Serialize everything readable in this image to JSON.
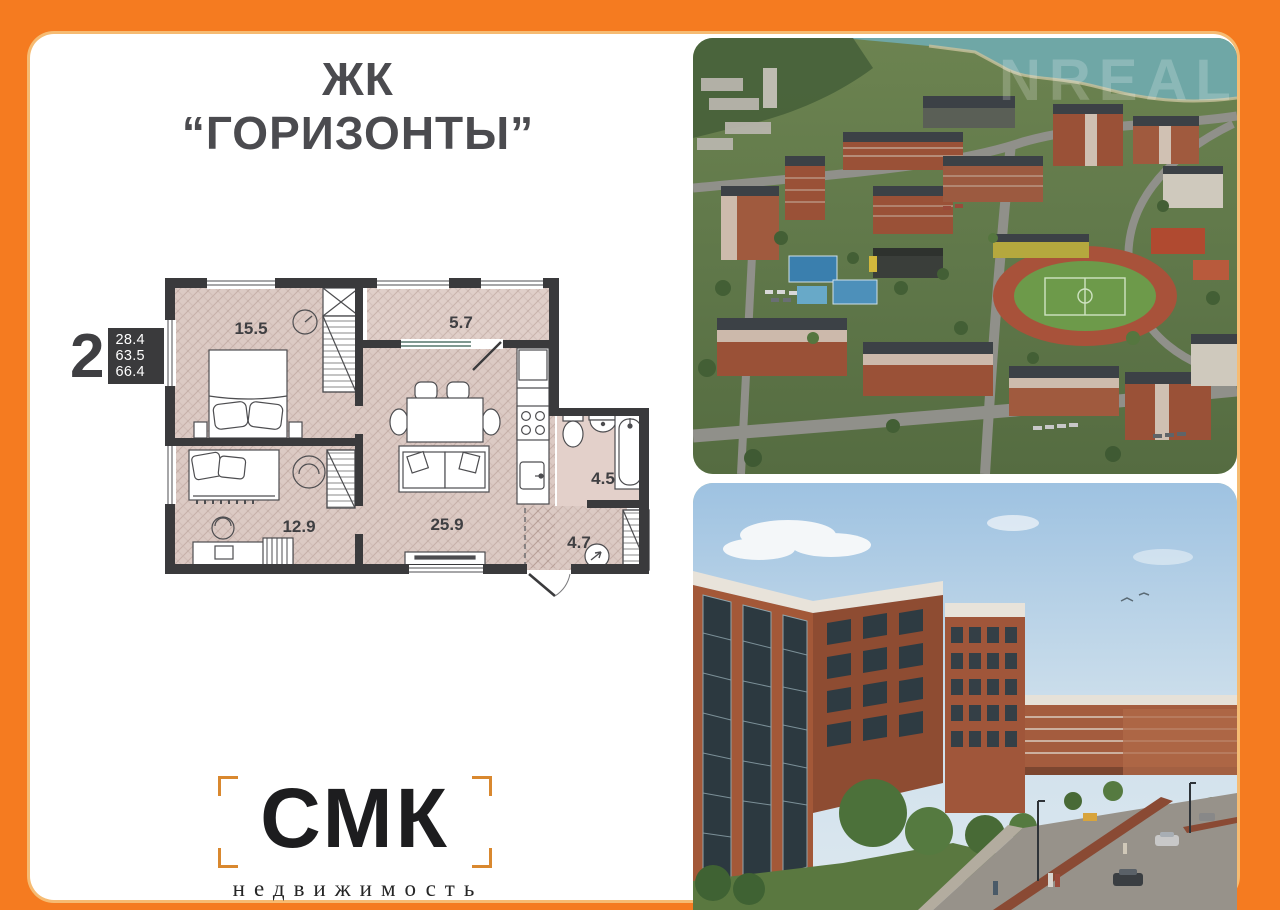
{
  "frame": {
    "border_color": "#f57b20",
    "panel_color": "#ffffff"
  },
  "header": {
    "title": "ЖК “ГОРИЗОНТЫ”"
  },
  "floor_plan": {
    "spec": {
      "rooms_count": "2",
      "areas": [
        "28.4",
        "63.5",
        "66.4"
      ]
    },
    "rooms": [
      {
        "id": "bedroom",
        "area": "15.5"
      },
      {
        "id": "balcony",
        "area": "5.7"
      },
      {
        "id": "living-kitchen",
        "area": "25.9"
      },
      {
        "id": "second-room",
        "area": "12.9"
      },
      {
        "id": "bathroom",
        "area": "4.5"
      },
      {
        "id": "hallway",
        "area": "4.7"
      }
    ]
  },
  "photos": {
    "aerial": {
      "watermark": "NREAL"
    }
  },
  "logo": {
    "name": "СМК",
    "subtitle": "недвижимость"
  },
  "colors": {
    "wall": "#3a3a3c",
    "floor": "#dccac4",
    "brick": "#9a5137",
    "accent_orange": "#d9882f"
  }
}
